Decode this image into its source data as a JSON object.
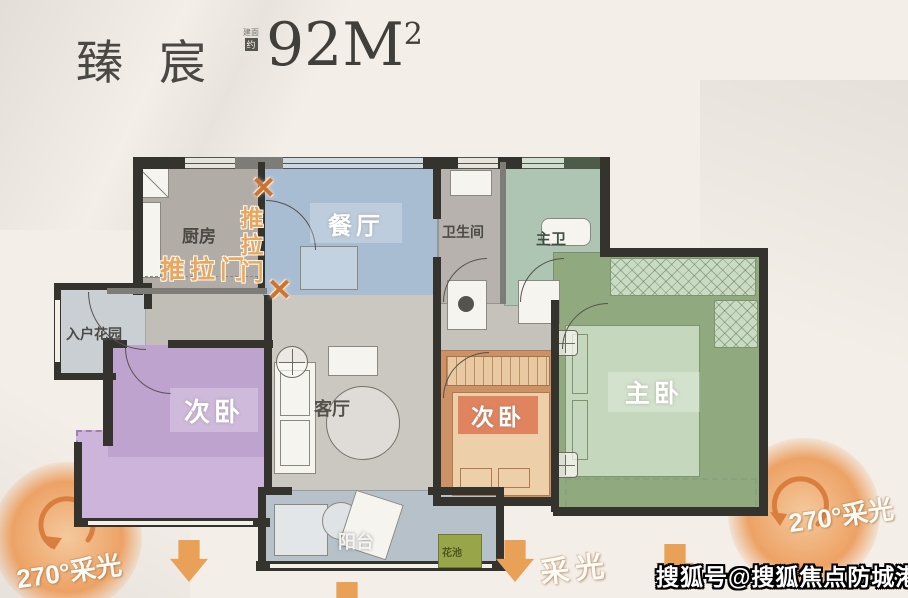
{
  "header": {
    "title": "臻宸",
    "stamp_top": "建面",
    "stamp_box": "约",
    "area_value": "92M",
    "area_sup": "2"
  },
  "rooms": {
    "kitchen": {
      "label": "厨房"
    },
    "dining": {
      "label": "餐厅"
    },
    "bathroom": {
      "label": "卫生间"
    },
    "master_bath": {
      "label": "主卫"
    },
    "entry_garden": {
      "label": "入户花园"
    },
    "bedroom_left": {
      "label": "次卧"
    },
    "living": {
      "label": "客厅"
    },
    "bedroom_mid": {
      "label": "次卧"
    },
    "master_bedroom": {
      "label": "主卧"
    },
    "balcony": {
      "label": "阳台"
    },
    "flower_bed": {
      "label": "花池"
    }
  },
  "annotations": {
    "sliding_door_horizontal": "推拉门",
    "sliding_door_vertical": "推拉门",
    "x_mark": "✕",
    "light_270_left": "270°采光",
    "light_270_right": "270°采光",
    "light_bottom": "采光"
  },
  "watermark": "搜狐号@搜狐焦点防城港站",
  "colors": {
    "accent_orange": "#e9a057",
    "dining_blue": "#a9bdd2",
    "bedroom_purple": "#bfa3cf",
    "bedroom_orange": "#cc9164",
    "master_green": "#91a97f",
    "bath_green": "#adc5b2",
    "balcony_blue": "#b6c1ca",
    "wall_dark": "#35332e",
    "background_cream": "#f3eee7"
  }
}
